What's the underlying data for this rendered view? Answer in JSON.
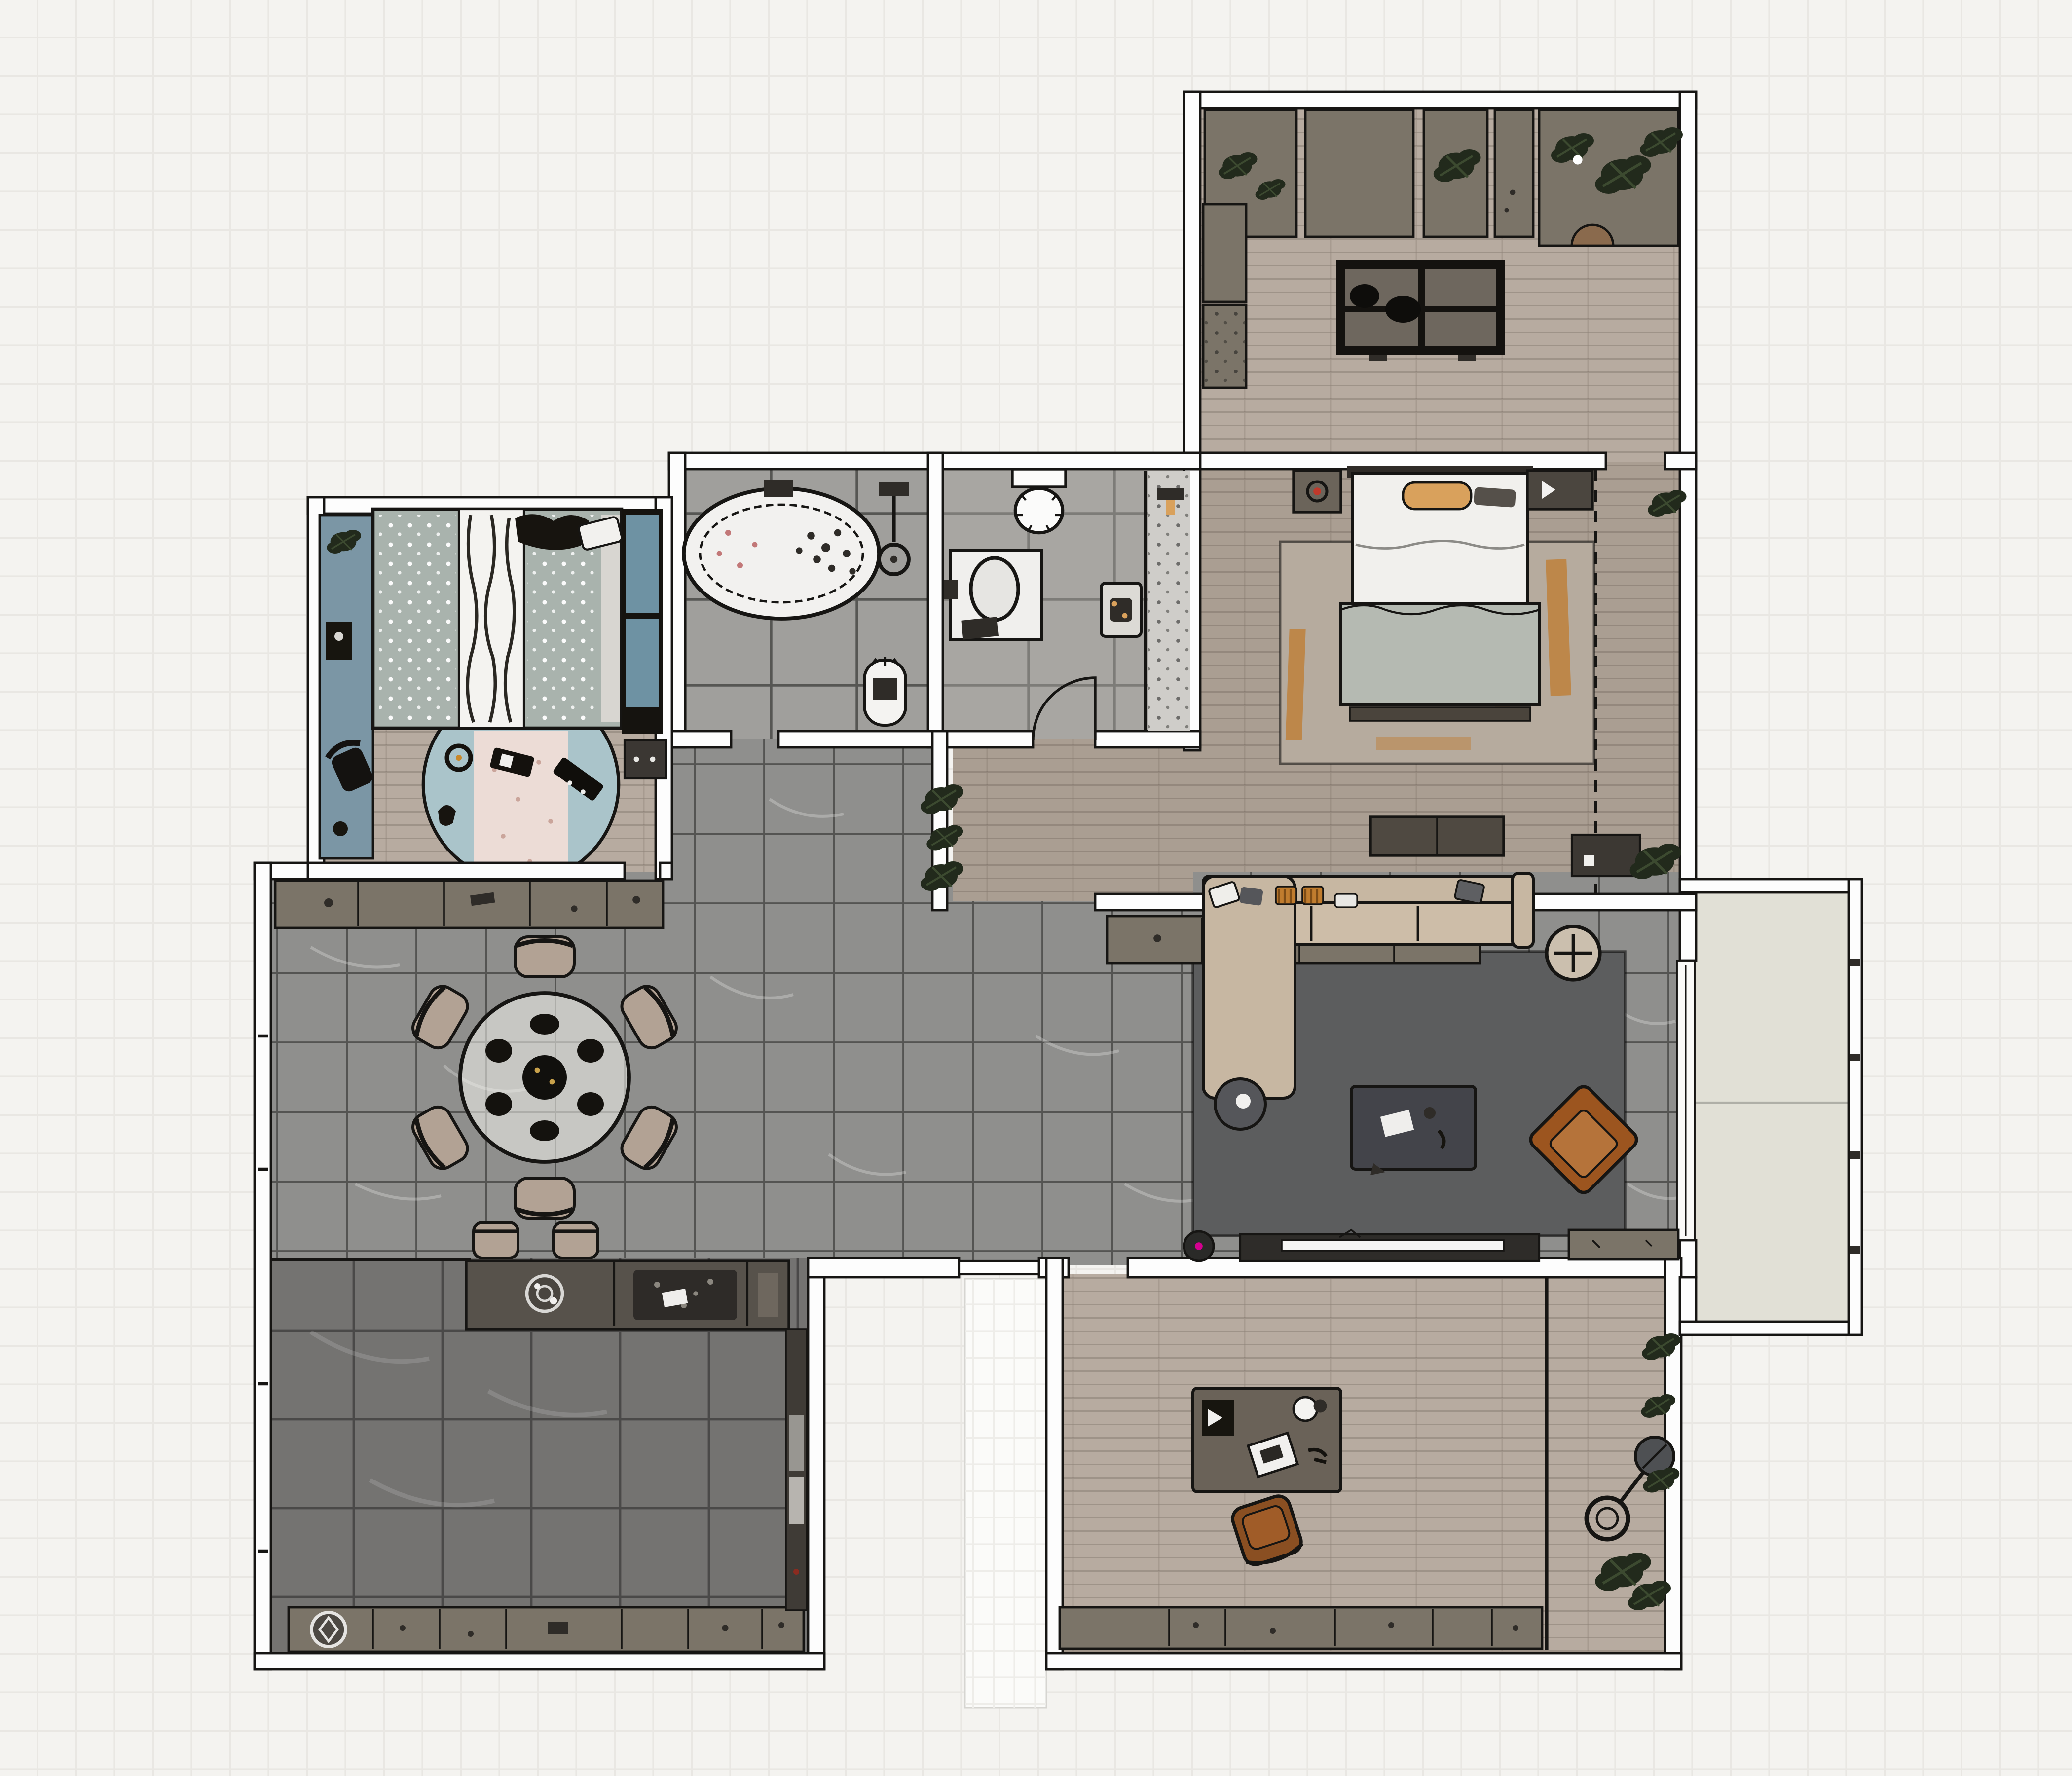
{
  "palette": {
    "bg": "#f4f3f0",
    "bggrid": "#e9e7e3",
    "wall": "#fdfdfd",
    "line": "#161513",
    "wood": "#b7aba0",
    "woodd": "#aa9e92",
    "tile": "#8f8f8d",
    "tilebath": "#a09f9c",
    "tilewc": "#a8a6a2",
    "kfloor": "#747371",
    "balcony": "#e1e0d6",
    "porch": "#fbfbf9",
    "rugdark": "#5c5d5e",
    "rugmaster": "#b6ab9e",
    "orange": "#c07c2e",
    "sofa": "#c7b7a2",
    "chair": "#b2a294",
    "armchair": "#9c551f",
    "armchairlight": "#b5733a",
    "counter": "#7b7468",
    "counterdark": "#57524b",
    "island": "#6e675e",
    "dark": "#2f2c28",
    "teal": "#7b96a5",
    "tealpanel": "#6e92a3",
    "sage": "#a9b3ad",
    "kidsrug": "#aac4ca",
    "kidsinner": "#ecdcd6",
    "linen": "#f1f0ed",
    "blanket": "#b5bab2",
    "tan": "#d9a15c",
    "plant": "#222a1c",
    "red": "#c0392b",
    "magenta": "#d4008f",
    "glass": "#cfcdc9",
    "tv": "#f5f5f4"
  },
  "plan": {
    "type": "apartment-floor-plan-top-view",
    "rooms": [
      {
        "key": "study",
        "label": "study-work-room",
        "floor": "light-wood-planks",
        "furniture": [
          "wall-counter-with-planters",
          "side-counter",
          "double-desk-island",
          "desk-chairs",
          "stool"
        ]
      },
      {
        "key": "master-bedroom",
        "label": "master-bedroom",
        "floor": "taupe-wood-planks",
        "furniture": [
          "double-bed",
          "tan-pillow",
          "sage-blanket",
          "foot-bench",
          "nightstand-with-lamp",
          "media-cabinet",
          "area-rug-orange-accents",
          "dresser",
          "wardrobe-dashed-outline",
          "storage-bench",
          "plant"
        ]
      },
      {
        "key": "bathroom",
        "label": "bathroom",
        "floor": "gray-tile",
        "furniture": [
          "oval-bathtub-with-petals",
          "shower-fixture",
          "water-heater"
        ]
      },
      {
        "key": "wc",
        "label": "shower-room",
        "floor": "gray-tile",
        "furniture": [
          "vanity-with-oval-sink",
          "toilet",
          "bath-mat",
          "glass-shower-screen",
          "door-swing"
        ]
      },
      {
        "key": "kids-bedroom",
        "label": "kids-bedroom",
        "floor": "light-wood-planks",
        "furniture": [
          "teal-desk-strip",
          "desk-chair",
          "single-bed-dotted-bedding",
          "birch-pattern-blanket",
          "pillows",
          "wardrobe-teal-doors",
          "low-cabinet",
          "round-play-rug",
          "toys"
        ]
      },
      {
        "key": "dining-area",
        "label": "dining-area",
        "floor": "gray-marble-tile",
        "furniture": [
          "round-dining-table",
          "place-settings",
          "dining-chairs",
          "sideboard"
        ]
      },
      {
        "key": "living-area",
        "label": "living-area",
        "floor": "gray-marble-tile",
        "furniture": [
          "sectional-sofa-with-chaise",
          "throw-pillows",
          "round-side-table",
          "coffee-table",
          "leather-armchair",
          "round-tray-table",
          "dark-area-rug",
          "tv-console",
          "tv",
          "robot-vacuum",
          "sideboard",
          "low-cabinet"
        ]
      },
      {
        "key": "kitchen",
        "label": "kitchen",
        "floor": "dark-gray-tile",
        "furniture": [
          "bar-counter",
          "round-sink",
          "cooktop",
          "bar-stools",
          "base-cabinet-row",
          "washing-machine",
          "tall-unit-column"
        ]
      },
      {
        "key": "home-office",
        "label": "home-office",
        "floor": "light-wood-planks",
        "furniture": [
          "desk",
          "speaker",
          "laptop",
          "desk-lamp",
          "office-chair",
          "base-cabinet-row",
          "arc-floor-lamp",
          "potted-plants"
        ]
      },
      {
        "key": "balcony",
        "label": "balcony",
        "floor": "pale-deck",
        "furniture": [
          "railing",
          "sliding-glass-door"
        ]
      },
      {
        "key": "hallway",
        "label": "hallway",
        "floor": "gray-marble-tile",
        "furniture": [
          "plant-divider"
        ]
      },
      {
        "key": "entry-porch",
        "label": "entry-porch",
        "floor": "white-panel",
        "furniture": [
          "front-door"
        ]
      }
    ],
    "counts": {
      "rooms": 12,
      "dining_chairs": 6,
      "bar_stools": 2,
      "island_desk_panels": 4
    }
  }
}
